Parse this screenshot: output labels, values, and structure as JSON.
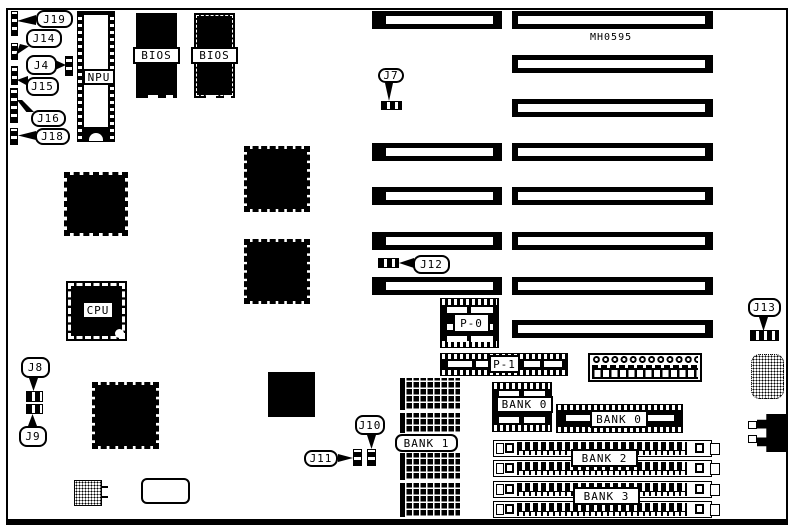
{
  "board": {
    "part_number": "MH0595",
    "callouts": {
      "j4": "J4",
      "j7": "J7",
      "j8": "J8",
      "j9": "J9",
      "j10": "J10",
      "j11": "J11",
      "j12": "J12",
      "j13": "J13",
      "j14": "J14",
      "j15": "J15",
      "j16": "J16",
      "j18": "J18",
      "j19": "J19"
    },
    "chips": {
      "npu": "NPU",
      "bios_left": "BIOS",
      "bios_right": "BIOS",
      "cpu": "CPU"
    },
    "headers": {
      "p0": "P-0",
      "p1": "P-1"
    },
    "memory_banks": {
      "bank0_left": "BANK 0",
      "bank0_right": "BANK 0",
      "bank1": "BANK 1",
      "bank2": "BANK 2",
      "bank3": "BANK 3"
    }
  }
}
